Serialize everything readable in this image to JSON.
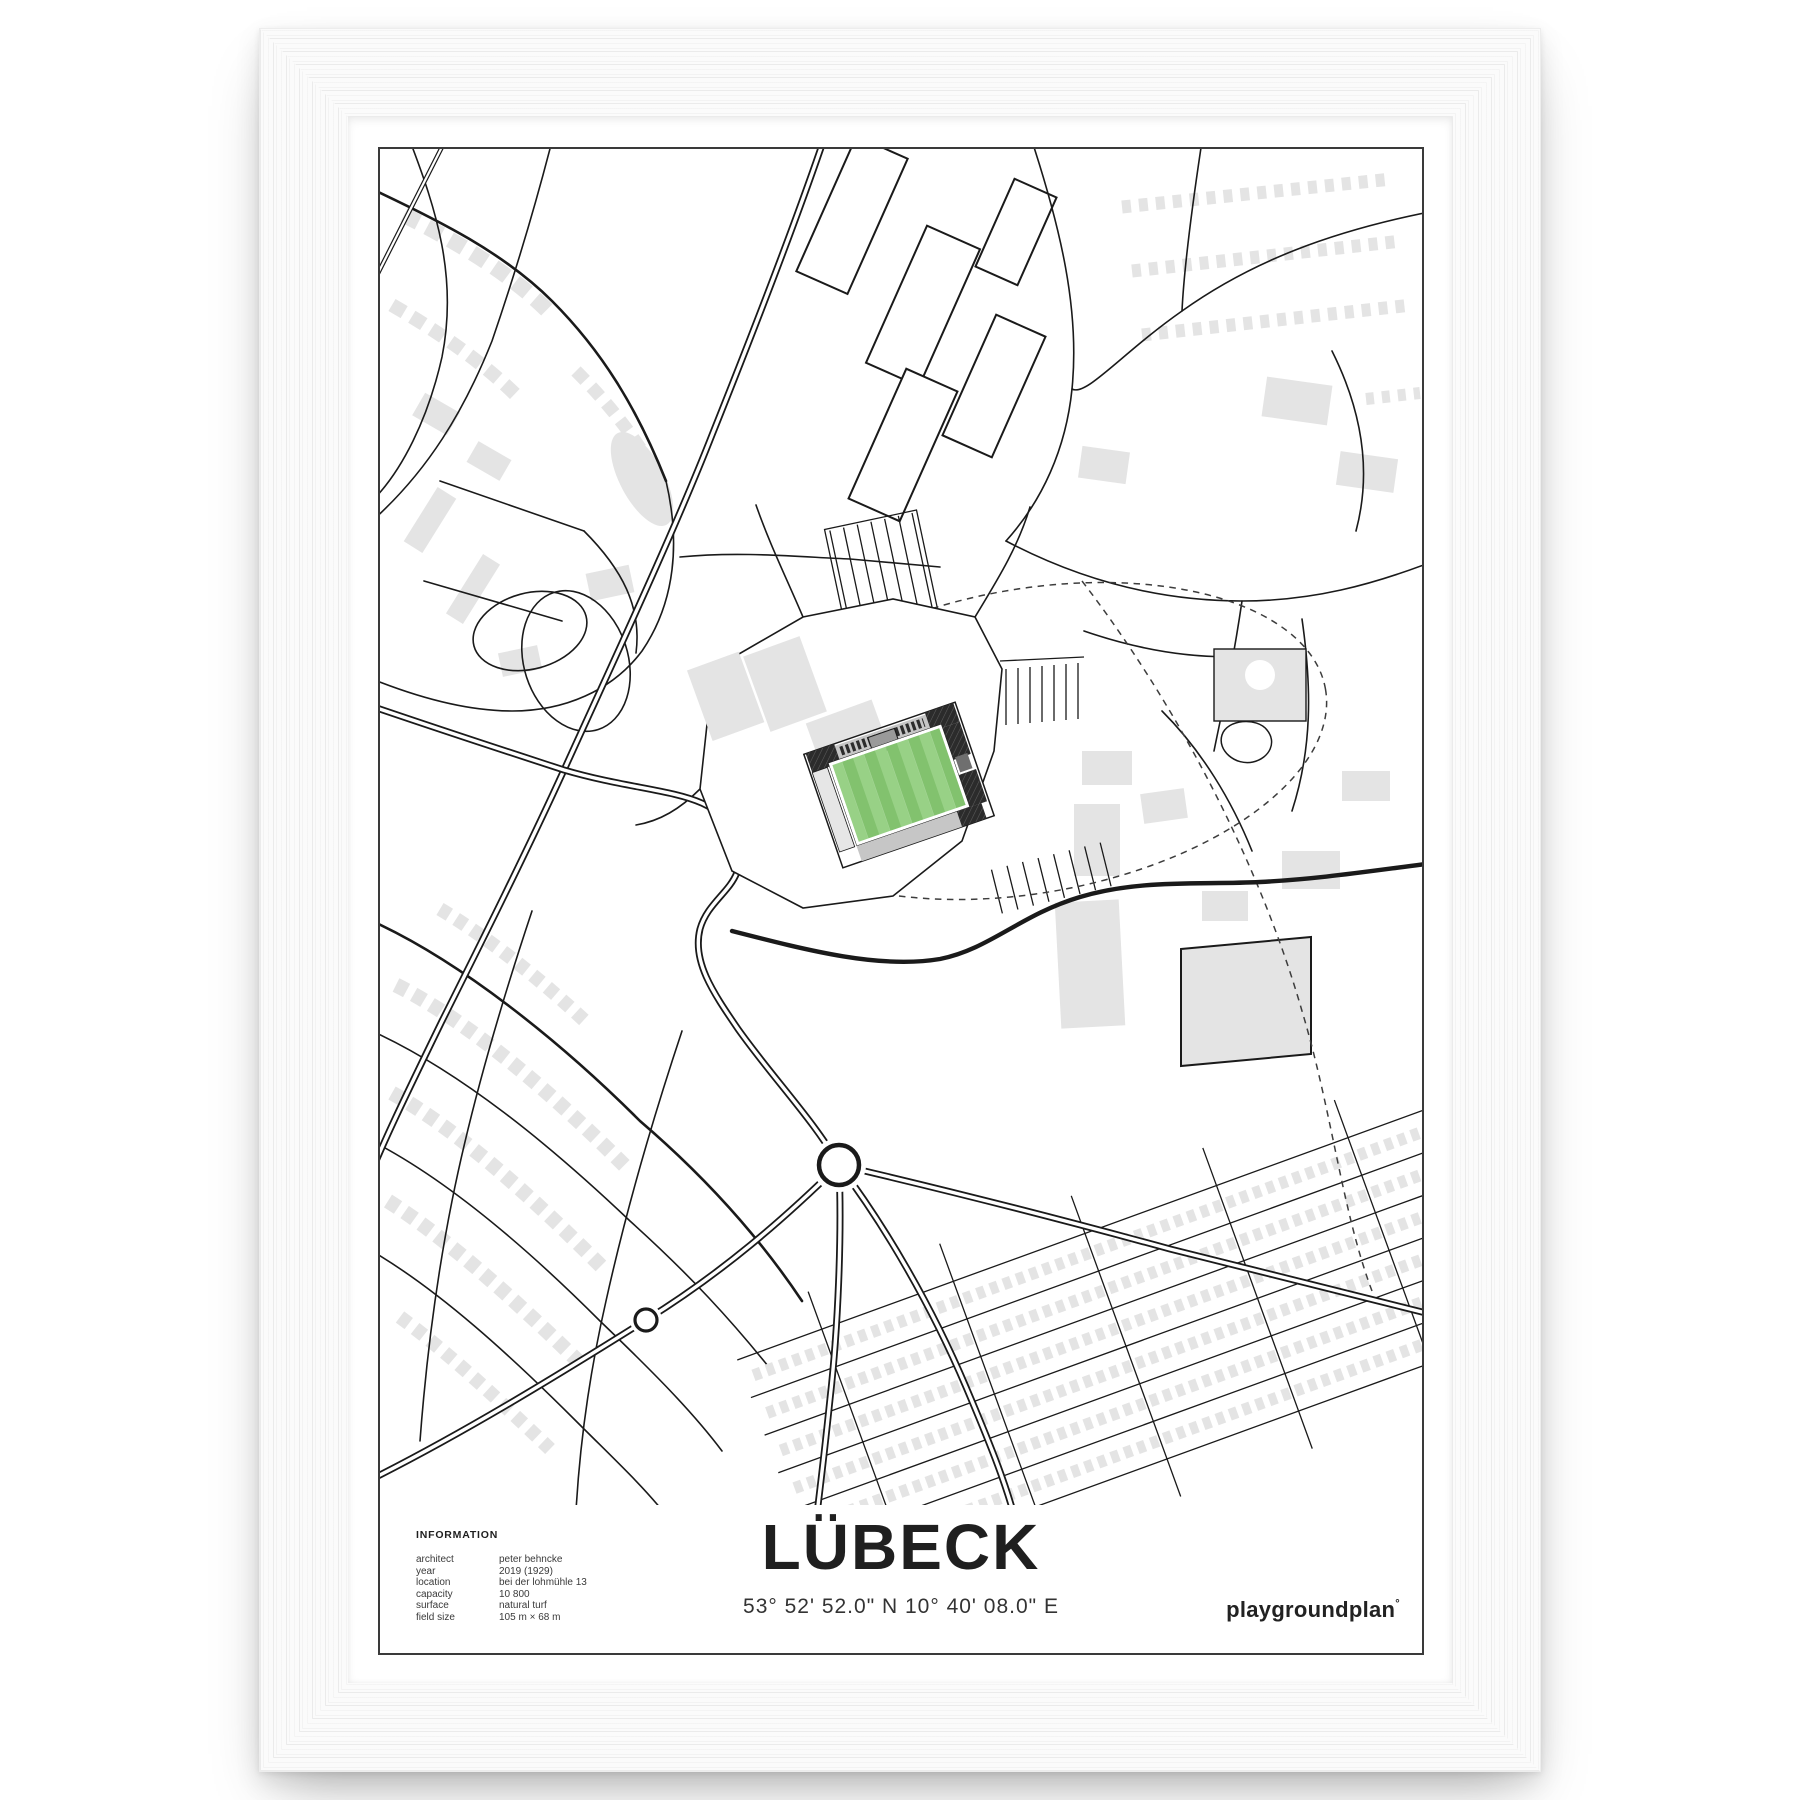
{
  "poster": {
    "title": "LÜBECK",
    "coordinates": "53° 52' 52.0\" N 10° 40' 08.0\" E",
    "brand": "playgroundplan",
    "brand_mark": "°",
    "information": {
      "heading": "INFORMATION",
      "rows": [
        {
          "label": "architect",
          "value": "peter behncke"
        },
        {
          "label": "year",
          "value": "2019 (1929)"
        },
        {
          "label": "location",
          "value": "bei der lohmühle 13"
        },
        {
          "label": "capacity",
          "value": "10 800"
        },
        {
          "label": "surface",
          "value": "natural turf"
        },
        {
          "label": "field size",
          "value": "105 m × 68 m"
        }
      ]
    }
  },
  "map": {
    "description": "minimalist street map of Lübeck centered on the Lohmühle stadium",
    "colors": {
      "street": "#1a1a1a",
      "building": "#e4e4e4",
      "pitch-light": "#98d186",
      "pitch-dark": "#82c26e",
      "stand-dark": "#2b2b2b",
      "stand-gray": "#c6c6c6",
      "stand-mid": "#9a9a9a"
    }
  }
}
